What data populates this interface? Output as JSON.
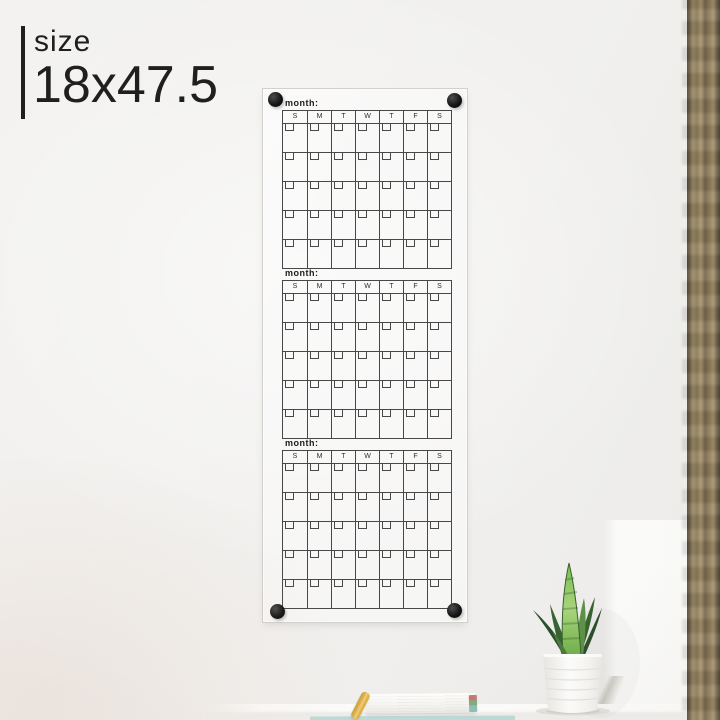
{
  "size_label": {
    "heading": "size",
    "value": "18x47.5"
  },
  "board": {
    "months": [
      {
        "label": "month:",
        "days": [
          "S",
          "M",
          "T",
          "W",
          "T",
          "F",
          "S"
        ],
        "week_rows": 5
      },
      {
        "label": "month:",
        "days": [
          "S",
          "M",
          "T",
          "W",
          "T",
          "F",
          "S"
        ],
        "week_rows": 5
      },
      {
        "label": "month:",
        "days": [
          "S",
          "M",
          "T",
          "W",
          "T",
          "F",
          "S"
        ],
        "week_rows": 5
      }
    ],
    "standoff_count": 4
  },
  "scene_objects": [
    "acrylic-calendar-board",
    "standoff-screw",
    "snake-plant",
    "plant-pot",
    "shelf",
    "white-book",
    "gold-pen",
    "teal-book",
    "wood-trim"
  ],
  "colors": {
    "accent_text": "#1f1f1f",
    "wall": "#f1f0ee",
    "grid_line": "#484848",
    "wood_trim": "#8a7a5e",
    "leaf_dark": "#2c4f2b",
    "leaf_mid": "#376331",
    "leaf_light": "#8cc063",
    "pot": "#fbfbfa",
    "pen_gold": "#ddb14e",
    "book_teal": "#bcdcd8"
  }
}
